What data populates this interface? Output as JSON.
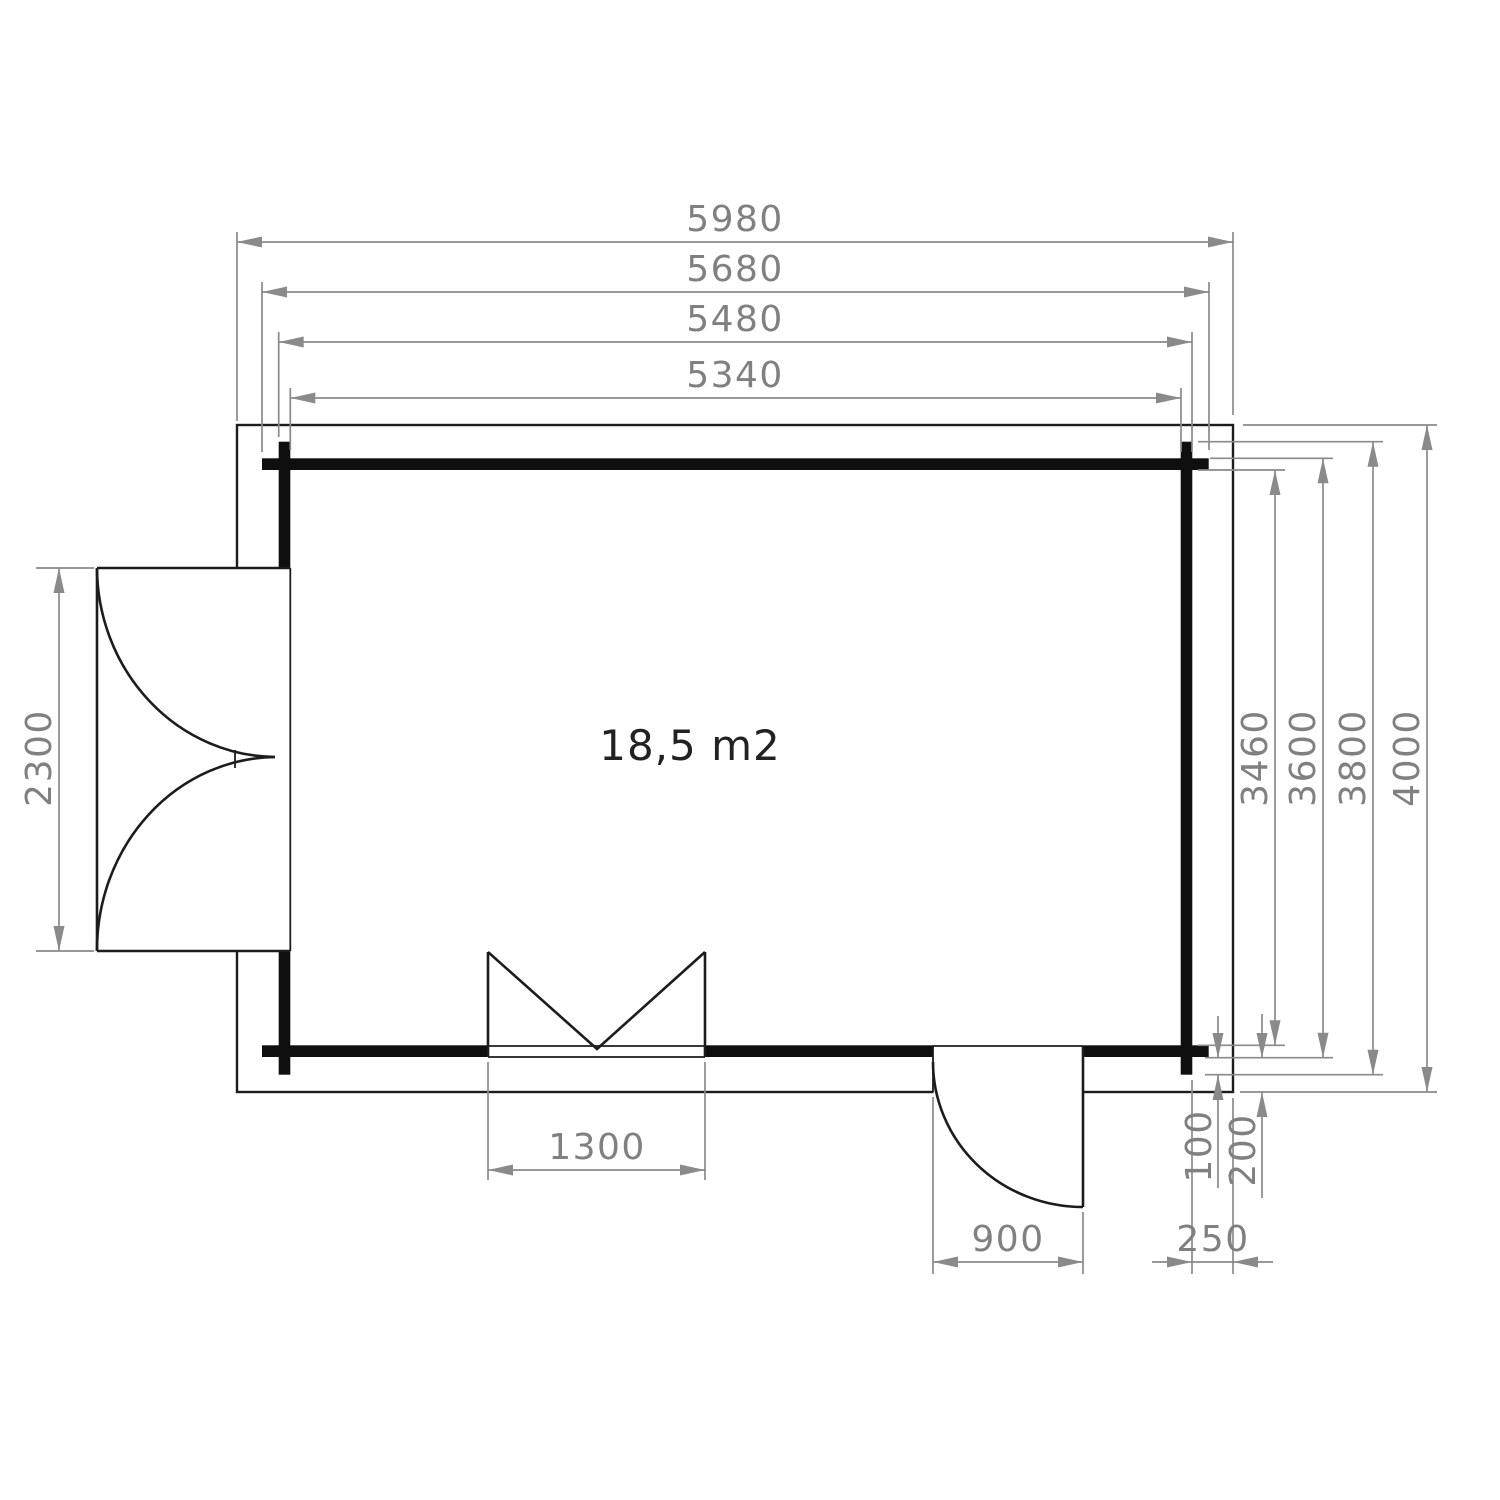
{
  "floor_plan": {
    "area_label": "18,5 m2",
    "dimensions": {
      "top": [
        "5980",
        "5680",
        "5480",
        "5340"
      ],
      "right": [
        "3460",
        "3600",
        "3800",
        "4000"
      ],
      "left": [
        "2300"
      ],
      "window_width": "1300",
      "door_width": "900",
      "corner": {
        "log_end": "100",
        "wall_offset": "200",
        "side_overhang": "250"
      }
    },
    "colors": {
      "wall": "#0f0f0f",
      "outline": "#1c1c1c",
      "dimension": "#8a8a8a",
      "dimension_text": "#808080",
      "area_text": "#222222",
      "background": "#ffffff"
    }
  }
}
